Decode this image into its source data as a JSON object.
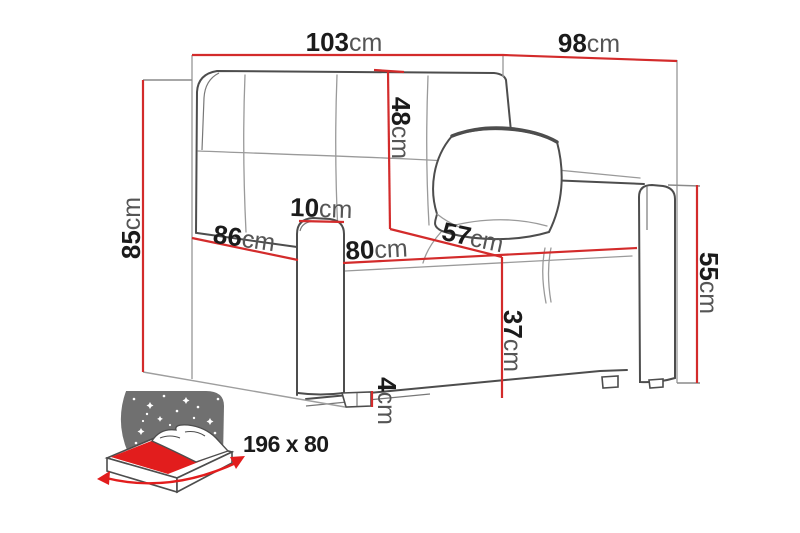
{
  "diagram": {
    "type": "sofa-bed-dimension-diagram",
    "unit": "cm",
    "dimensions": {
      "overall_width": {
        "value": "103",
        "unit": "cm"
      },
      "overall_depth": {
        "value": "98",
        "unit": "cm"
      },
      "overall_height": {
        "value": "85",
        "unit": "cm"
      },
      "backrest_height": {
        "value": "48",
        "unit": "cm"
      },
      "armrest_width": {
        "value": "10",
        "unit": "cm"
      },
      "base_depth": {
        "value": "86",
        "unit": "cm"
      },
      "seat_width": {
        "value": "80",
        "unit": "cm"
      },
      "seat_depth": {
        "value": "57",
        "unit": "cm"
      },
      "seat_height": {
        "value": "37",
        "unit": "cm"
      },
      "leg_height": {
        "value": "4",
        "unit": "cm"
      },
      "armrest_height": {
        "value": "55",
        "unit": "cm"
      }
    },
    "sleeping_area": {
      "value": "196 x 80"
    },
    "icons": {
      "sleeping_function": "sofa-bed-night-icon"
    },
    "colors": {
      "dimension_line": "#d32b2b",
      "sofa_outline": "#4d4d4d",
      "bounding_box": "#9e9e9e",
      "icon_red": "#e21d1d",
      "icon_gray": "#707070",
      "number_text": "#1b1b1b",
      "unit_text": "#555555"
    }
  }
}
